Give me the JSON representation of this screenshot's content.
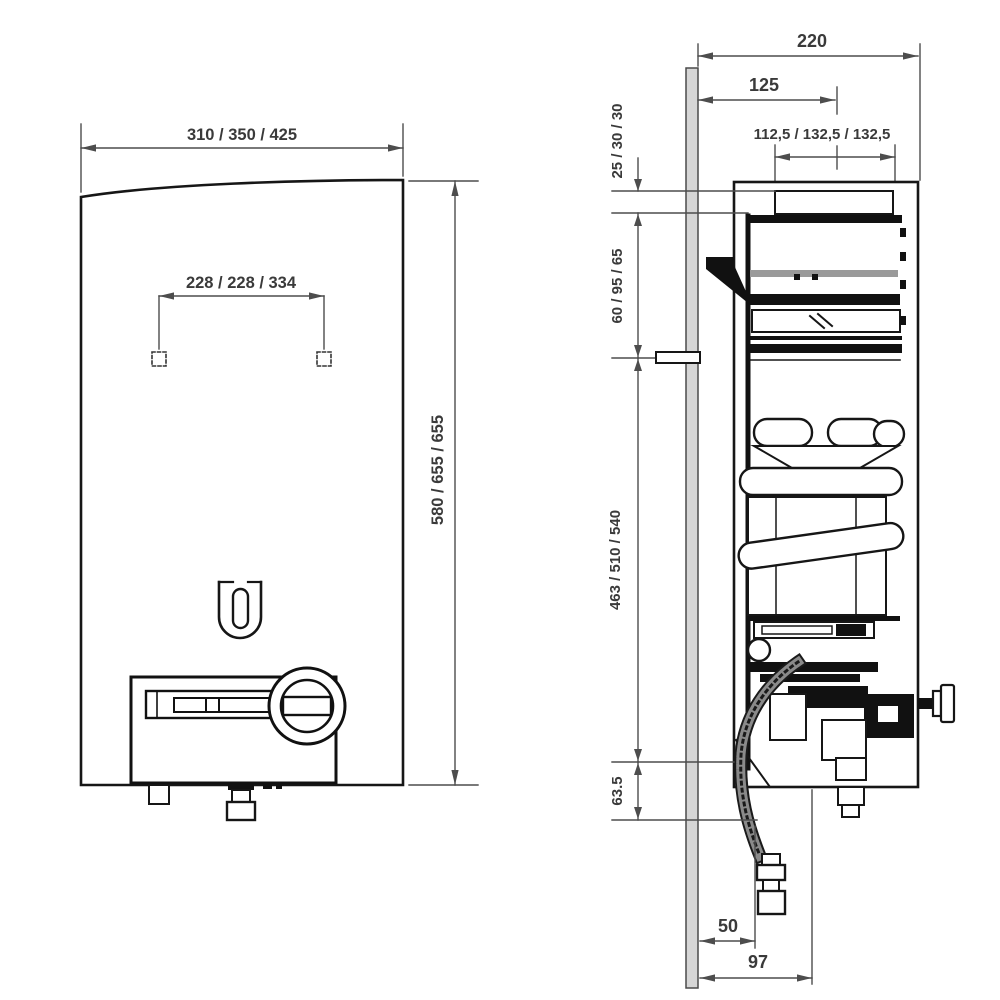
{
  "front_view": {
    "width": "310 / 350 / 425",
    "mount_spacing": "228 / 228 / 334",
    "height": "580 / 655 / 655"
  },
  "side_view": {
    "depth": "220",
    "flue_offset": "125",
    "flue_width": "112,5 / 132,5 / 132,5",
    "top_gap": "25 / 30 / 30",
    "upper_section": "60 / 95 / 65",
    "main_section": "463 / 510 / 540",
    "lower_gap": "63.5",
    "gas_offset": "50",
    "connection_offset": "97"
  },
  "colors": {
    "dimension_line": "#4d4d4d",
    "part_outline": "#161616",
    "wall_fill": "#d6d6d6",
    "background": "#ffffff"
  }
}
